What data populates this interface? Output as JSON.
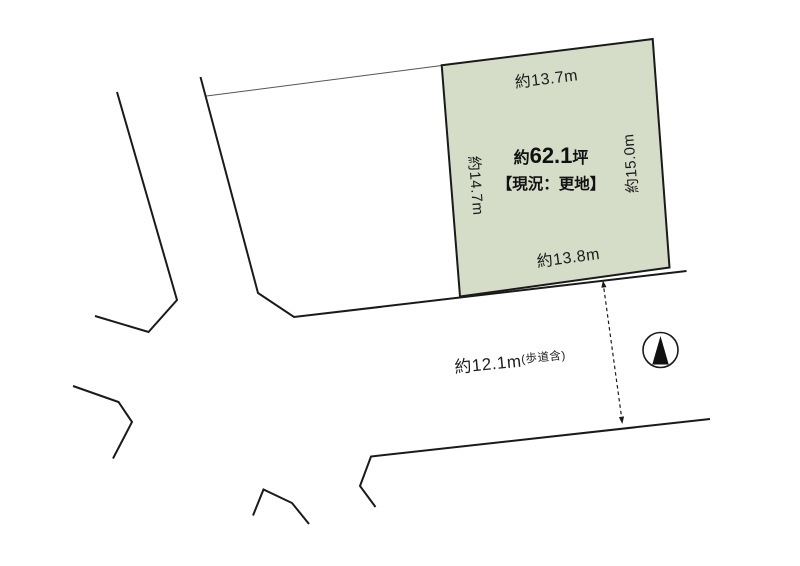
{
  "diagram": {
    "parcel": {
      "fill_color": "#d5dcc7",
      "area": {
        "prefix": "約",
        "value": "62.1",
        "unit": "坪"
      },
      "status": "【現況：更地】",
      "dimensions": {
        "top": "約13.7m",
        "left": "約14.7m",
        "right": "約15.0m",
        "bottom": "約13.8m"
      }
    },
    "road": {
      "width": "約12.1m",
      "width_note": "(歩道含)"
    },
    "compass": {
      "icon": "north-arrow",
      "direction": "up"
    }
  },
  "colors": {
    "background": "#ffffff",
    "parcel_fill": "#d5dcc7",
    "line": "#1a1a1a",
    "text": "#1c1c1c"
  }
}
